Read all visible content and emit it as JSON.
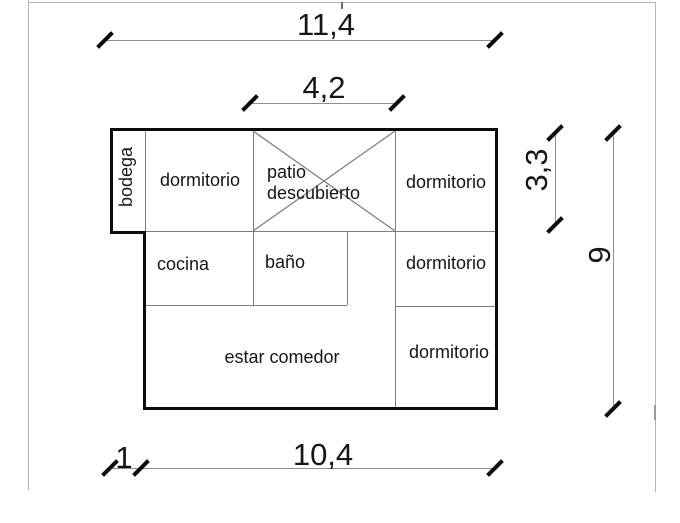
{
  "rooms": {
    "bodega": "bodega",
    "dormitorio_top_left": "dormitorio",
    "patio_line1": "patio",
    "patio_line2": "descubierto",
    "dormitorio_top_right": "dormitorio",
    "cocina": "cocina",
    "bano": "baño",
    "dormitorio_middle_right": "dormitorio",
    "estar_comedor": "estar comedor",
    "dormitorio_bottom_right": "dormitorio"
  },
  "dimensions": {
    "overall_width": "11,4",
    "patio_width": "4,2",
    "upper_right_height": "3,3",
    "overall_height": "9",
    "bodega_offset": "1",
    "main_width": "10,4"
  },
  "colors": {
    "wall": "#0b0b0b",
    "partition": "#7d7d7d",
    "dimension_line": "#8e8e8e",
    "tick": "#0d0d0d",
    "frame": "#b4b4b4",
    "text": "#161616",
    "background": "#ffffff"
  }
}
